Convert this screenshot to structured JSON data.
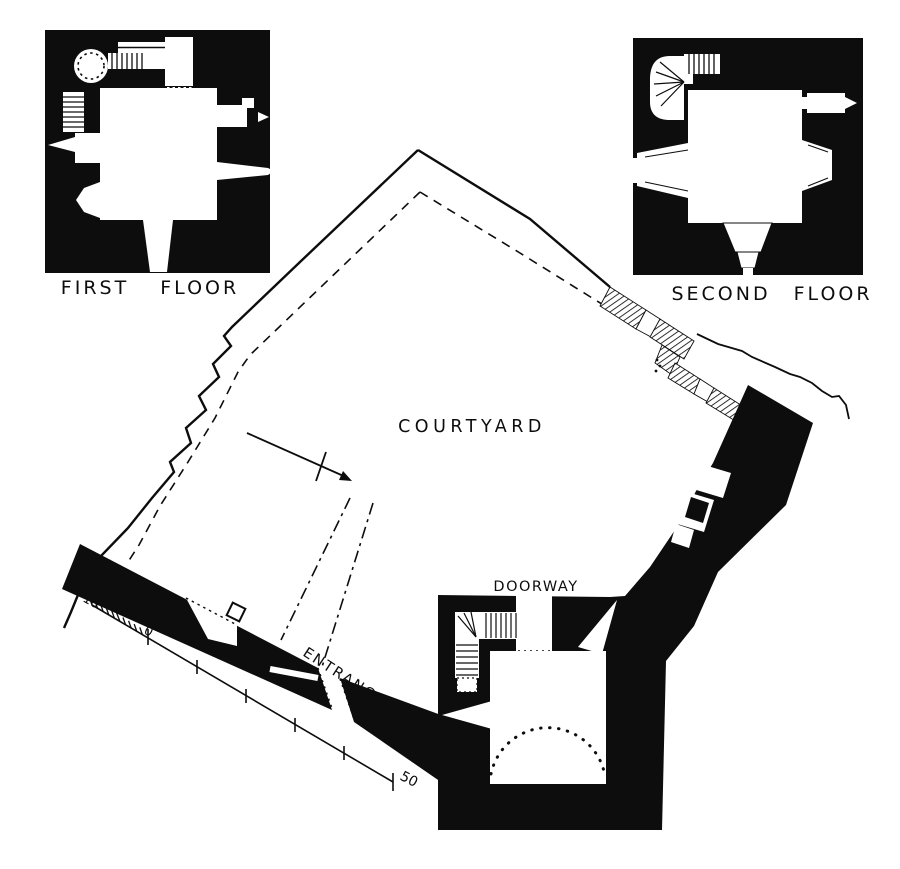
{
  "figure": {
    "kind": "architectural-plan",
    "colors": {
      "ink": "#0d0d0d",
      "paper": "#ffffff"
    }
  },
  "insets": {
    "first_floor_label": "FIRST FLOOR",
    "second_floor_label": "SECOND FLOOR"
  },
  "plan_labels": {
    "courtyard": "COURTYARD",
    "doorway": "DOORWAY",
    "entrance": "ENTRANCE"
  },
  "scale_bar": {
    "left_label": "10",
    "zero_label": "0",
    "right_label": "50"
  }
}
